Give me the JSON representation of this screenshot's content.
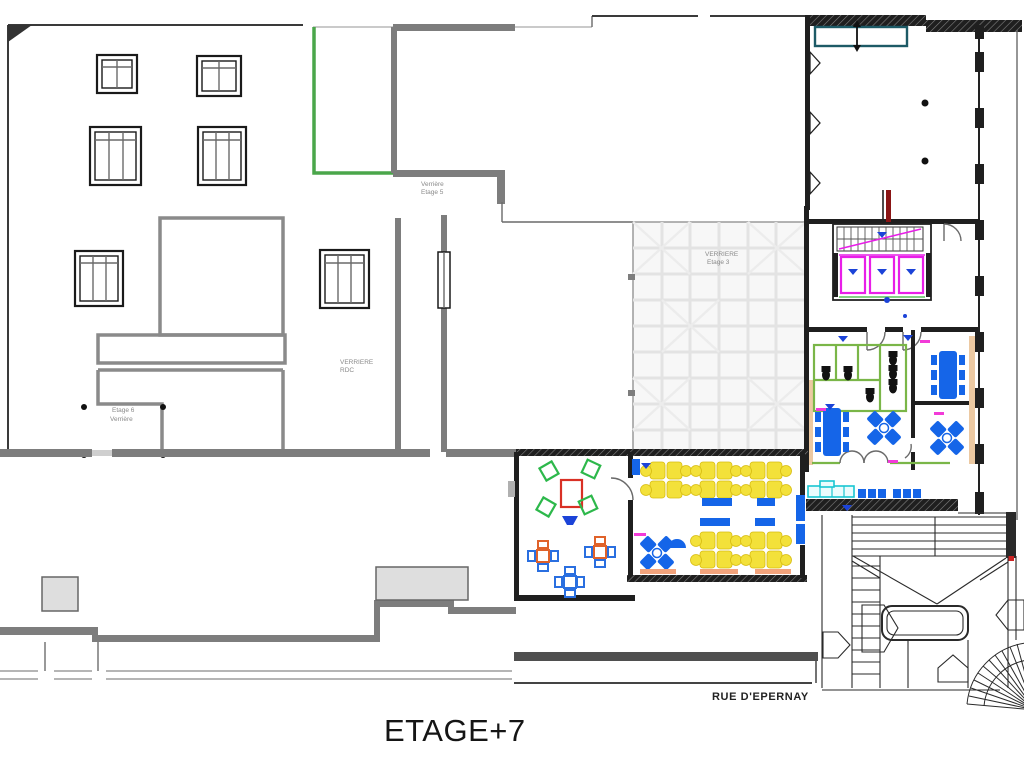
{
  "drawing": {
    "floor_title": "ETAGE+7",
    "street_name": "RUE D'EPERNAY",
    "labels": {
      "verriere_rdc_line1": "VERRIERE",
      "verriere_rdc_line2": "RDC",
      "etage6_line1": "Etage 6",
      "etage6_line2": "Verrière",
      "etage5_line1": "Verrière",
      "etage5_line2": "Etage 5",
      "etage3_line1": "VERRIERE",
      "etage3_line2": "Etage 3"
    },
    "palette": {
      "wall_dark": "#1f1f1f",
      "wall_gray": "#7d7d7d",
      "street_gray": "#b5b5b5",
      "glass_grid": "#e3e3e3",
      "green_wall": "#4aa64a",
      "partition_green": "#7ab648",
      "furniture_blue": "#1565e8",
      "desk_yellow": "#f3e13a",
      "elevator_magenta": "#e81ee8",
      "counter_cyan": "#18c6d2",
      "table_red": "#d93025",
      "chair_green": "#2db84b",
      "radiator_orange": "#f2a37c",
      "riser_dark_red": "#8a1515",
      "vent_teal": "#1d5a66"
    }
  }
}
